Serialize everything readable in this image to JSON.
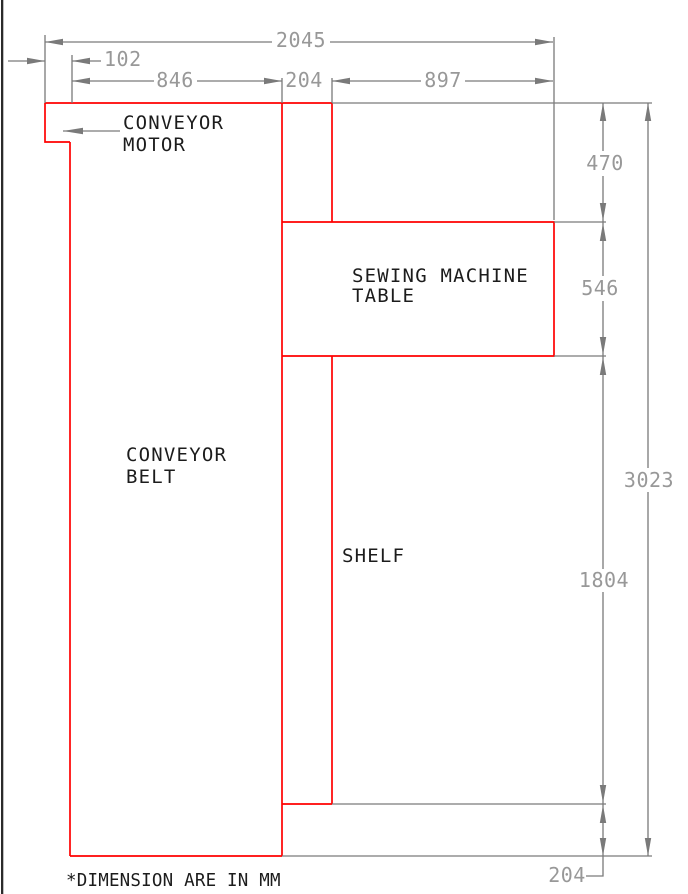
{
  "drawing": {
    "note": "*DIMENSION ARE IN MM",
    "labels": {
      "conveyor_motor": {
        "line1": "CONVEYOR",
        "line2": "MOTOR"
      },
      "conveyor_belt": {
        "line1": "CONVEYOR",
        "line2": "BELT"
      },
      "sewing_machine_table": {
        "line1": "SEWING MACHINE",
        "line2": "TABLE"
      },
      "shelf": "SHELF"
    },
    "dimensions_mm": {
      "overall_width": "2045",
      "motor_overhang_width": "102",
      "conveyor_belt_width": "846",
      "shelf_width": "204",
      "sewing_table_width": "897",
      "top_section_height": "470",
      "sewing_table_height": "546",
      "overall_height": "3023",
      "shelf_height": "1804",
      "bottom_section_height": "204"
    },
    "colors": {
      "outline": "#ff0000",
      "dimension_line": "#7a7a7a",
      "dimension_text": "#989898",
      "label_text": "#1c1c1c",
      "left_border": "#2b2b2b",
      "background": "#ffffff"
    }
  }
}
